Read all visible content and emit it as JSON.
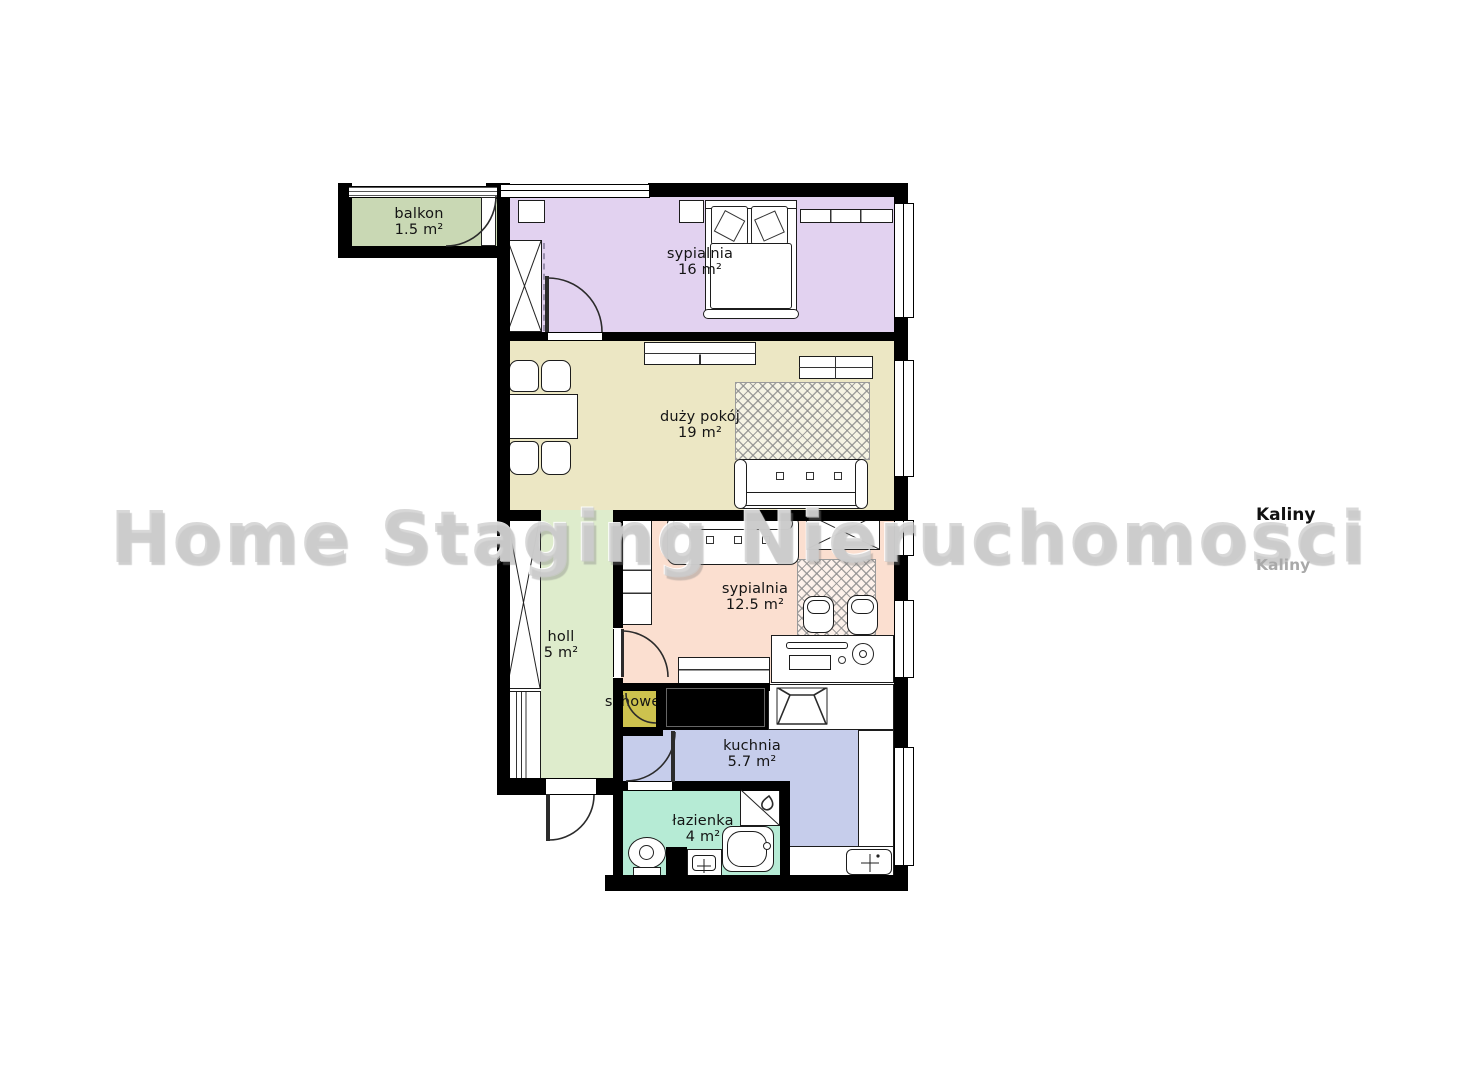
{
  "watermark": {
    "text": "Home Staging Nieruchomosci",
    "color": "rgba(203,203,203,0.74)"
  },
  "branding": {
    "kaliny_top": "Kaliny",
    "kaliny_bottom": "Kaliny"
  },
  "rooms": {
    "balkon": {
      "name": "balkon",
      "area": "1.5 m²",
      "color": "#c9d8b4"
    },
    "sypialnia16": {
      "name": "sypialnia",
      "area": "16 m²",
      "color": "#e2d2f0"
    },
    "duzy_pokoj": {
      "name": "duży pokój",
      "area": "19 m²",
      "color": "#ece7c4"
    },
    "sypialnia12": {
      "name": "sypialnia",
      "area": "12.5 m²",
      "color": "#fbdfd0"
    },
    "holl": {
      "name": "holl",
      "area": "5 m²",
      "color": "#deeccc"
    },
    "schowek": {
      "name": "schowek",
      "color": "#cdc24e"
    },
    "kuchnia": {
      "name": "kuchnia",
      "area": "5.7 m²",
      "color": "#c6cdeb"
    },
    "lazienka": {
      "name": "łazienka",
      "area": "4 m²",
      "color": "#b6ebd5"
    }
  },
  "colors": {
    "wall": "#000000",
    "furniture_outline": "#1c1c1c"
  }
}
